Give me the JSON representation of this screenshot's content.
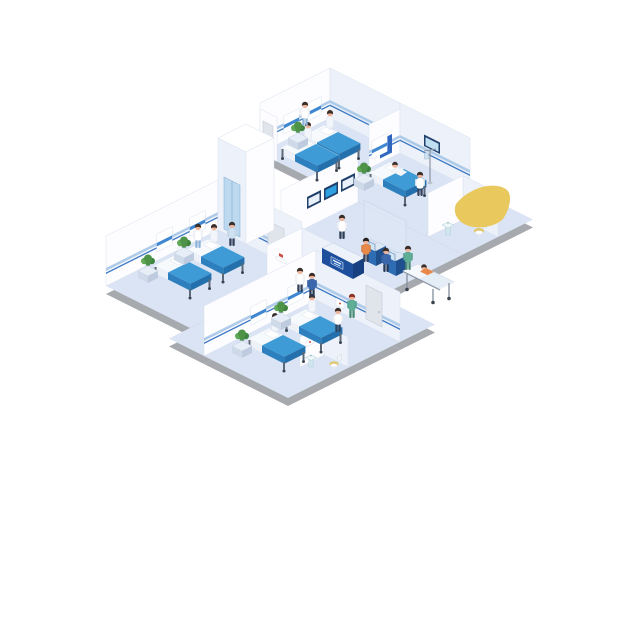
{
  "illustration": {
    "label": "Isometric hospital ward floor illustration",
    "background": "#ffffff"
  },
  "rooms": [
    "ward-top",
    "ward-right",
    "ward-left",
    "ward-bottom",
    "lobby",
    "corridor",
    "bathroom-right",
    "bathroom-bottom",
    "utility-room",
    "elevator"
  ],
  "colors": {
    "floor": "#dbe4f4",
    "slab": "#a6a9ae",
    "wall_white": "#fdfdff",
    "wall_shade": "#edf2fa",
    "wall_top": "#ffffff",
    "wall_line": "#d8e0ee",
    "rail_light": "#aecbe9",
    "rail_dark": "#3e79c4",
    "door": "#e0e4eb",
    "poster": "#2f66c0",
    "headboard": "#ffffff",
    "headboard_stripe": "#3f87d0",
    "bed_top": "#3f9bd6",
    "bed_side": "#2d80bd",
    "bed_side_dark": "#2470ad",
    "sheet": "#f7fafd",
    "sheet_front": "#eef2f8",
    "bed_leg": "#5b6878",
    "caster": "#39434f",
    "desk_front": "#1d4f9c",
    "desk_side": "#16407f",
    "desk_top": "#eef3fb",
    "sign_bg": "#2e66b5",
    "kiosk_front": "#2e6db4",
    "kiosk_side": "#1f4f8c",
    "kiosk_screen": "#cfe6f5",
    "screen_frame": "#20406b",
    "screen_blue": "#2e9fe0",
    "screen_white": "#e8f1f9",
    "glass": "#dce8f4",
    "elev_door": "#bcd9f0",
    "blob": "#e9c85e",
    "plant_green1": "#4f9348",
    "plant_green2": "#5fa855",
    "plant_green3": "#3f8440",
    "plant_pot": "#9fb9c8",
    "table_top": "#e8eef7",
    "table_front": "#cfdae9",
    "table_side": "#bfccdf",
    "skin": "#eeb49b",
    "hair": "#3a2e2a",
    "gown": "#f2f6fb",
    "sink_body": "#cfe7ec",
    "sink_basin": "#eef7f9",
    "toilet_seat": "#e3c761",
    "toilet_white": "#fdfdfd",
    "frame_red": "#c94f44",
    "gold": "#d8b84a",
    "metal": "#8a94a2",
    "gurney_top": "#f5f8fc",
    "gurney_blanket": "#e5edf7",
    "orange": "#e8894a"
  },
  "beds": [
    {
      "x": 324,
      "y": 125,
      "room": "ward-top"
    },
    {
      "x": 302,
      "y": 137,
      "room": "ward-top"
    },
    {
      "x": 390,
      "y": 162,
      "room": "ward-right"
    },
    {
      "x": 208,
      "y": 239,
      "room": "ward-left"
    },
    {
      "x": 175,
      "y": 255,
      "room": "ward-left"
    },
    {
      "x": 306,
      "y": 309,
      "room": "ward-bottom"
    },
    {
      "x": 269,
      "y": 328,
      "room": "ward-bottom"
    }
  ],
  "sitting_patients": [
    {
      "x": 330,
      "y": 127
    },
    {
      "x": 308,
      "y": 139
    },
    {
      "x": 214,
      "y": 241
    },
    {
      "x": 181,
      "y": 257
    },
    {
      "x": 312,
      "y": 311
    },
    {
      "x": 275,
      "y": 330
    }
  ],
  "plants": [
    {
      "x": 296,
      "y": 138
    },
    {
      "x": 362,
      "y": 179
    },
    {
      "x": 182,
      "y": 253
    },
    {
      "x": 146,
      "y": 271
    },
    {
      "x": 279,
      "y": 318
    },
    {
      "x": 240,
      "y": 346
    }
  ],
  "figures": [
    {
      "role": "ward-top-nurse",
      "x": 305,
      "y": 126,
      "outfit": "#ffffff",
      "pants": "#8fb4d9",
      "hair": "#3a2e2a"
    },
    {
      "role": "ward-right-doctor",
      "x": 420,
      "y": 196,
      "outfit": "#ffffff",
      "pants": "#33415c",
      "hair": "#3a2e2a"
    },
    {
      "role": "ward-left-nurse",
      "x": 198,
      "y": 248,
      "outfit": "#ffffff",
      "pants": "#8fb4d9",
      "hair": "#3a2e2a"
    },
    {
      "role": "ward-bottom-doctor",
      "x": 338,
      "y": 332,
      "outfit": "#ffffff",
      "pants": "#33415c",
      "hair": "#3a2e2a"
    },
    {
      "role": "receptionist",
      "x": 342,
      "y": 239,
      "outfit": "#ffffff",
      "pants": "#2c3e55",
      "hair": "#3a2e2a"
    },
    {
      "role": "kiosk-user-1",
      "x": 366,
      "y": 262,
      "outfit": "#e8894a",
      "pants": "#33415c",
      "hair": "#26201c"
    },
    {
      "role": "kiosk-user-2",
      "x": 386,
      "y": 272,
      "outfit": "#3b68ad",
      "pants": "#263a55",
      "hair": "#3a2e2a"
    },
    {
      "role": "gurney-nurse",
      "x": 408,
      "y": 270,
      "outfit": "#5fae96",
      "pants": "#4a8a76",
      "hair": "#3a2e2a"
    },
    {
      "role": "walking-nurse",
      "x": 352,
      "y": 318,
      "outfit": "#5fae96",
      "pants": "#4a8a76",
      "hair": "#8a3324"
    },
    {
      "role": "walking-doctor",
      "x": 300,
      "y": 292,
      "outfit": "#ffffff",
      "pants": "#33415c",
      "hair": "#3a2e2a"
    },
    {
      "role": "walking-patient",
      "x": 312,
      "y": 297,
      "outfit": "#3b68ad",
      "pants": "#263a55",
      "hair": "#3a2e2a"
    },
    {
      "role": "elevator-person",
      "x": 232,
      "y": 246,
      "outfit": "#cfe2f2",
      "pants": "#33415c",
      "hair": "#3a2e2a"
    }
  ],
  "equipment": {
    "info_screens": 3,
    "kiosks": 2,
    "beds_total": 7,
    "bathrooms": 2
  }
}
